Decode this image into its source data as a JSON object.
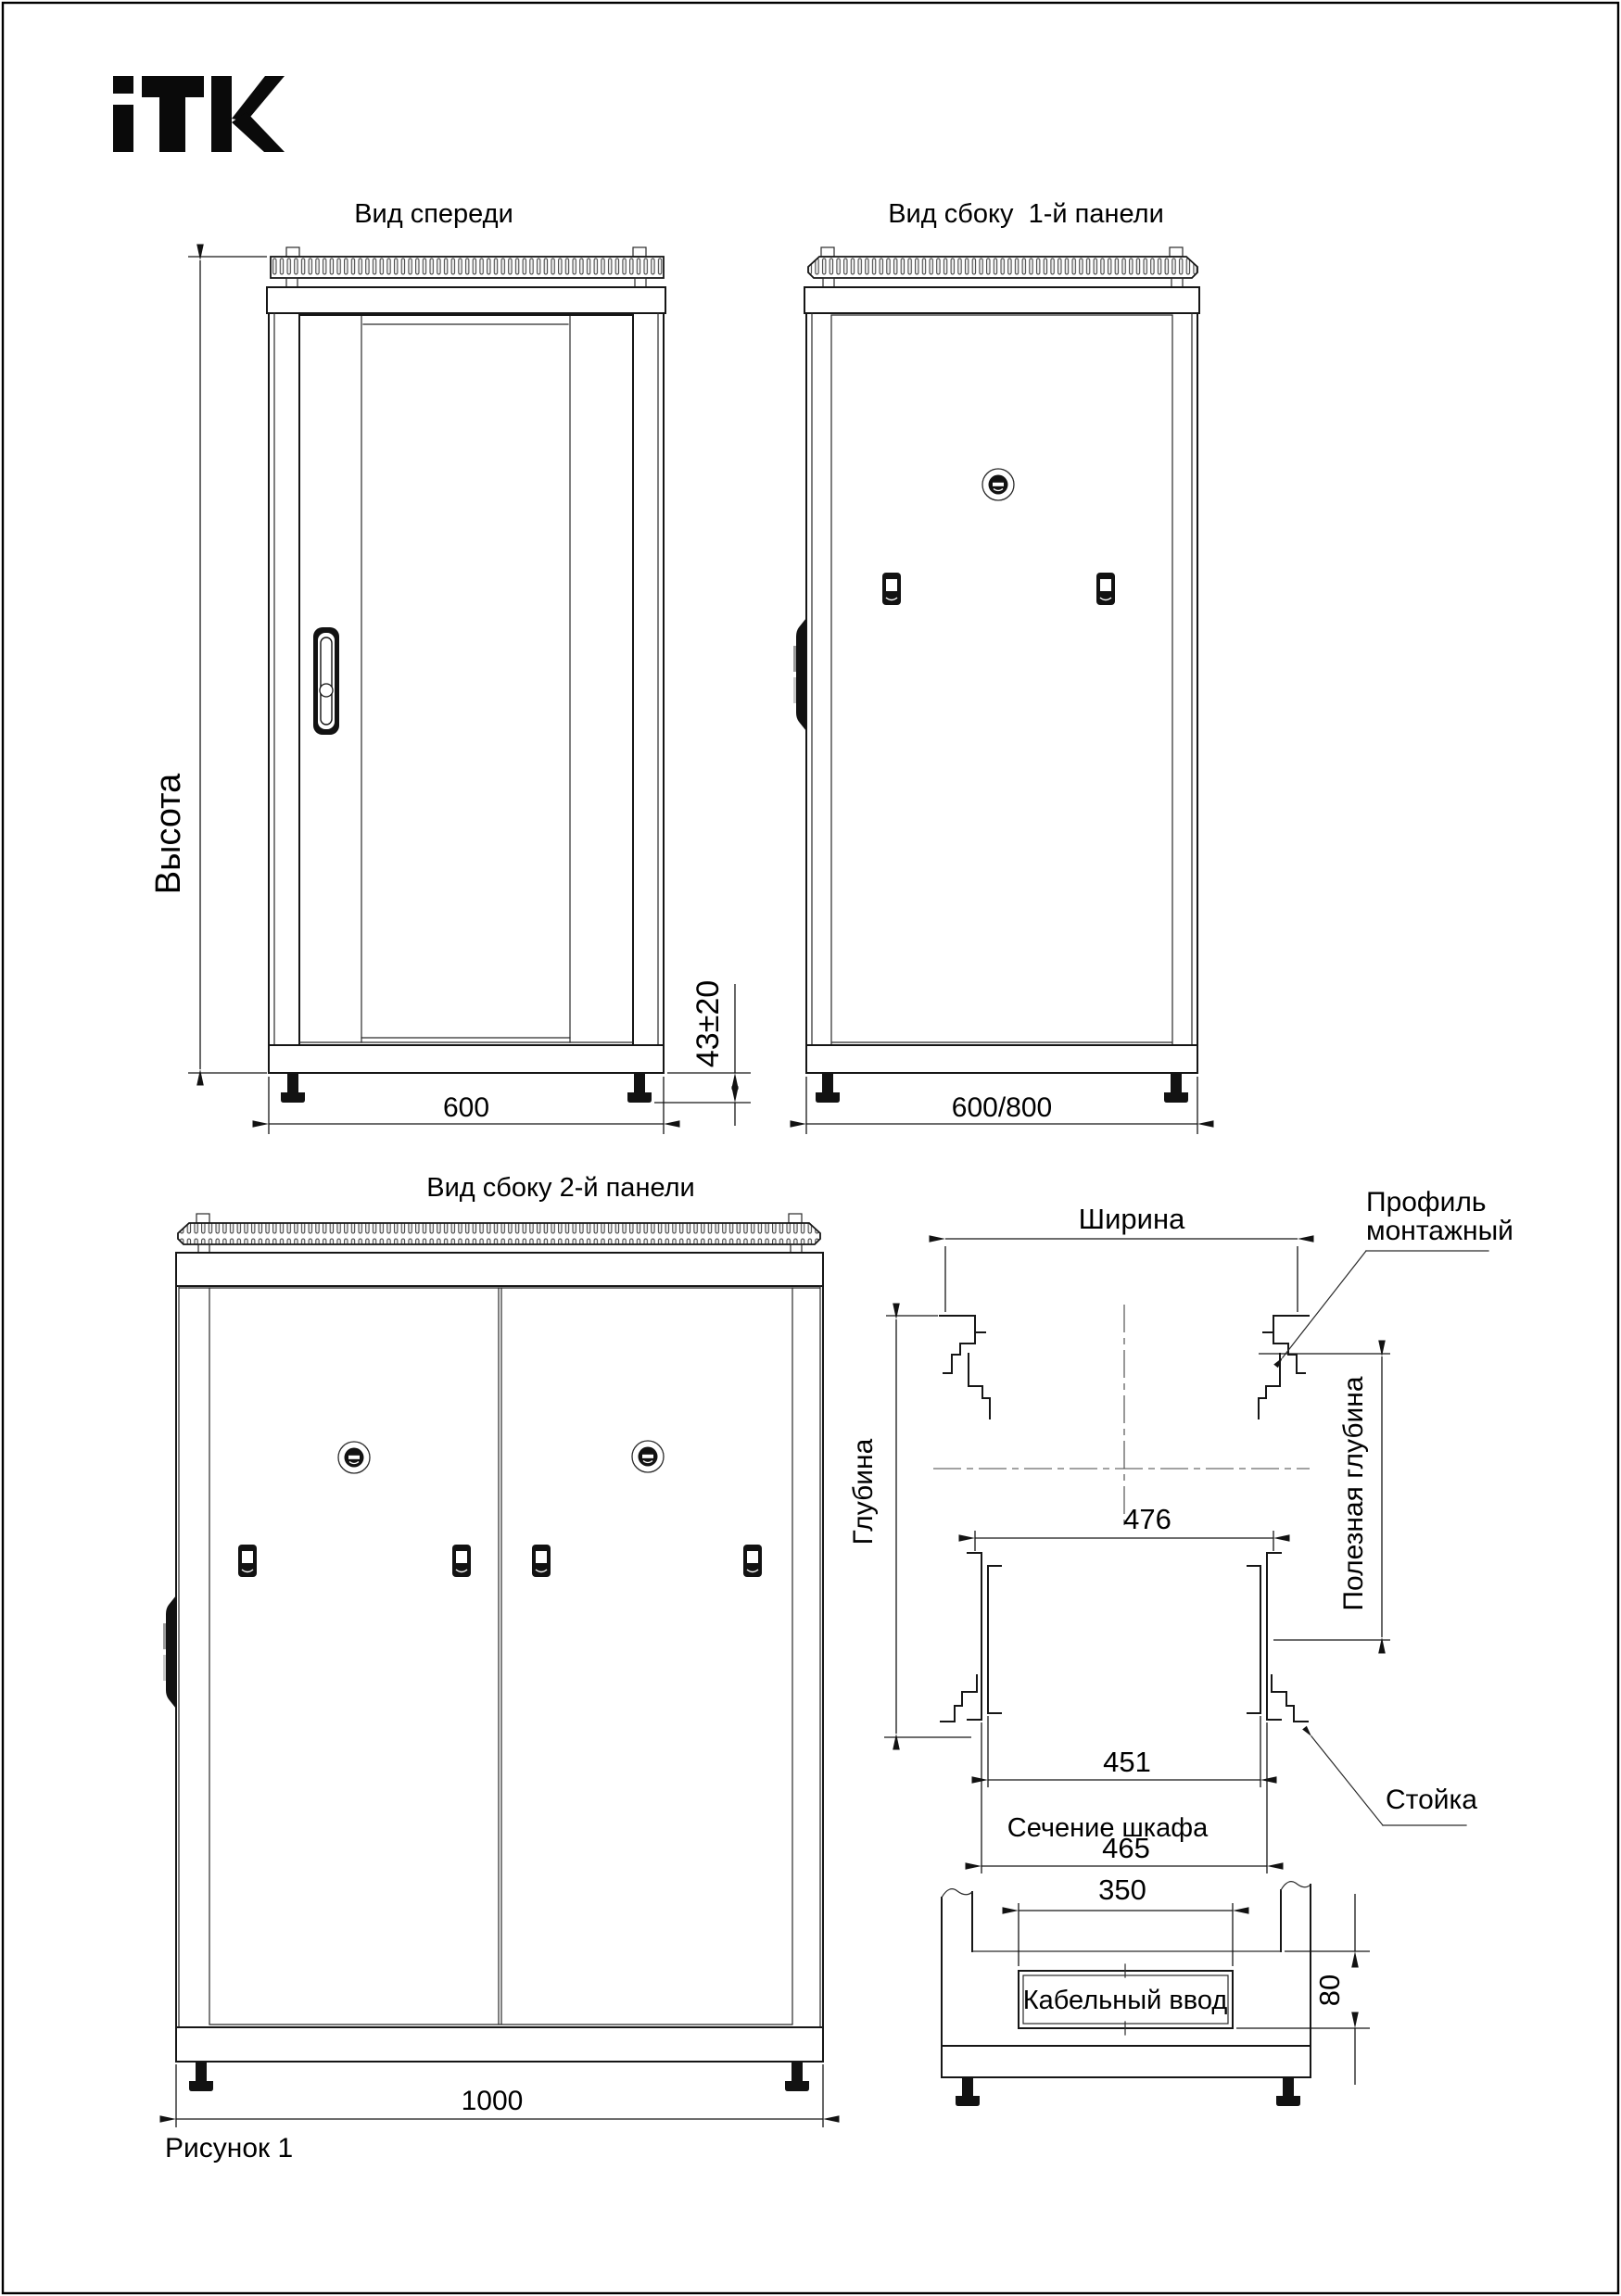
{
  "page": {
    "background": "#ffffff",
    "line_color": "#161616",
    "caption": "Рисунок 1"
  },
  "logo": {
    "brand": "ITK"
  },
  "views": {
    "front": {
      "title": "Вид спереди",
      "height_label": "Высота",
      "width_dim": "600",
      "foot_adjust_dim": "43±20"
    },
    "side1": {
      "title": "Вид сбоку  1-й панели",
      "depth_dim": "600/800"
    },
    "side2": {
      "title": "Вид сбоку 2-й панели",
      "depth_dim": "1000"
    },
    "top_section": {
      "width_label": "Ширина",
      "depth_label": "Глубина",
      "useful_depth_label": "Полезная глубина",
      "mounting_profile_label_1": "Профиль",
      "mounting_profile_label_2": "монтажный",
      "stand_label": "Стойка",
      "dim_476": "476",
      "dim_451": "451",
      "dim_465": "465"
    },
    "cabinet_section": {
      "title": "Сечение шкафа",
      "dim_350": "350",
      "dim_80": "80",
      "cable_entry_label": "Кабельный ввод"
    }
  }
}
